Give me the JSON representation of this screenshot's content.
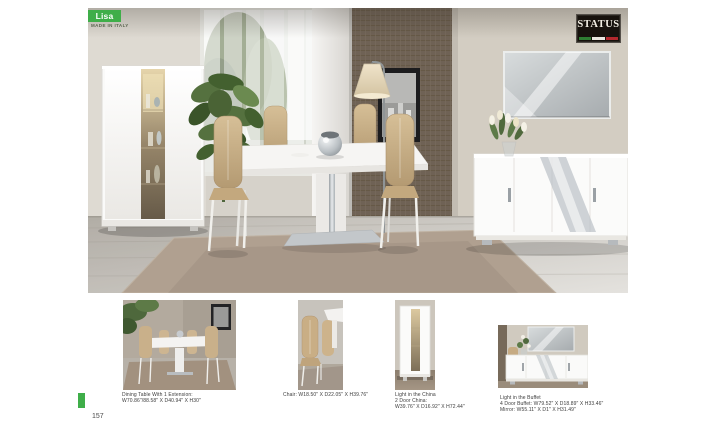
{
  "page": {
    "number": "157",
    "background": "#ffffff"
  },
  "header": {
    "collection_name": "Lisa",
    "collection_subtitle": "MADE IN ITALY",
    "accent_green": "#3fae49"
  },
  "brand": {
    "name": "STATUS",
    "flag_colors": [
      "#2e7d32",
      "#e9e7e0",
      "#b3282d"
    ]
  },
  "thumbnails": [
    {
      "name": "dining-table",
      "caption_lines": [
        "Dining Table With 1 Extension:",
        "W70.86\"/88.58\" X D40.94\" X H30\""
      ]
    },
    {
      "name": "chair",
      "caption_lines": [
        "Chair: W18.50\" X D22.05\" X H39.76\""
      ]
    },
    {
      "name": "china",
      "caption_lines": [
        "Light in the China",
        "2 Door China:",
        "W39.76\" X D16.92\" X H72.44\""
      ]
    },
    {
      "name": "buffet",
      "caption_lines": [
        "Light in the Buffet",
        "4 Door Buffet: W79.52\" X D18.89\" X H33.46\"",
        "Mirror: W55.11\" X D1\" X H31.49\""
      ]
    }
  ]
}
